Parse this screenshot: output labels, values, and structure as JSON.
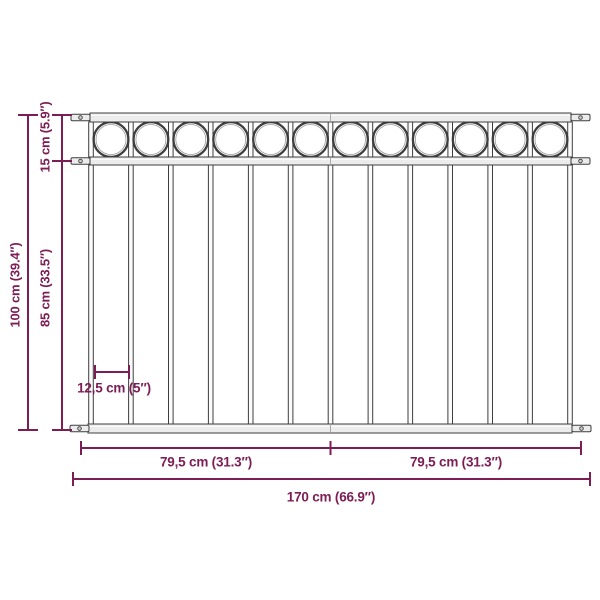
{
  "diagram": {
    "type": "product-dimension-diagram",
    "product": "fence-panel-with-ring-ornaments",
    "colors": {
      "dimension": "#7d1d55",
      "outline": "#3e3e3e",
      "fill": "#ececec",
      "inner_line": "#9a9a9a",
      "background": "#ffffff"
    },
    "structure": {
      "vertical_bars": 13,
      "rings": 12,
      "rails": 3,
      "mounting_plates": 6
    },
    "dimensions": {
      "total_height": "100 cm (39.4″)",
      "top_section_height": "15 cm (5.9″)",
      "lower_section_height": "85 cm (33.5″)",
      "bar_spacing": "12,5 cm (5″)",
      "left_half_width": "79,5 cm (31.3″)",
      "right_half_width": "79,5 cm (31.3″)",
      "total_width": "170 cm (66.9″)"
    }
  }
}
